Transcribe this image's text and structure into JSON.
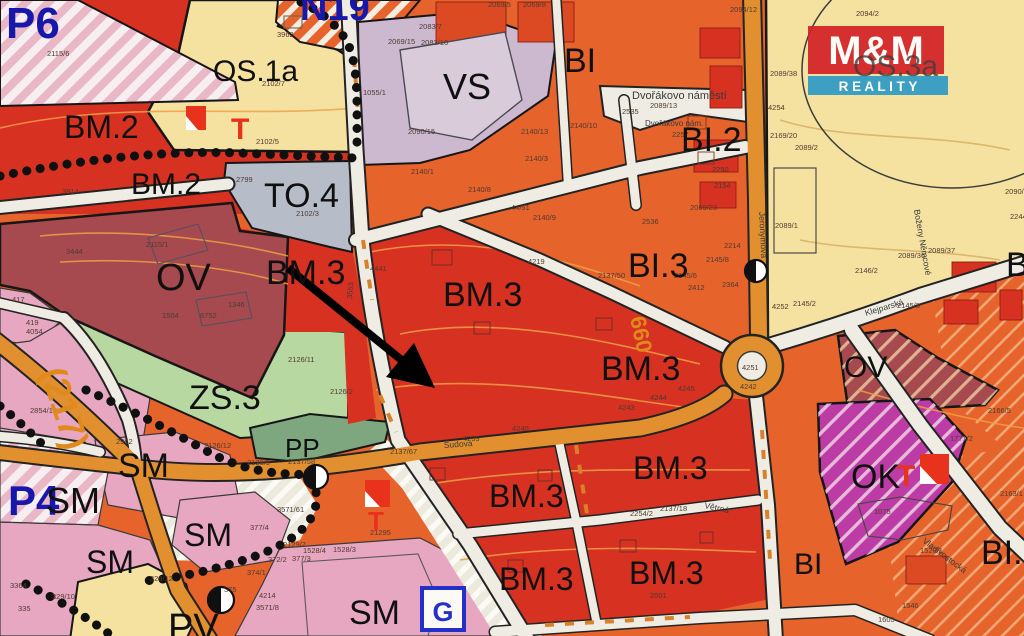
{
  "map": {
    "colors": {
      "bm_red": "#D73122",
      "bi_orange": "#E6632B",
      "os_yellow": "#F5E1A0",
      "vs_lavender": "#CDB9CF",
      "to_gray": "#B7BCC9",
      "ov_maroon": "#A64A4F",
      "zs_green": "#B8D8A2",
      "pp_green": "#7EA67F",
      "sm_pink": "#E7A7C1",
      "ok_magenta": "#BC3BA4",
      "road_cream": "#EFEDE3",
      "road_orange": "#E2902F",
      "plan_blue": "#1717AC",
      "logo_red": "#D42027",
      "logo_blue": "#2E9BC6"
    },
    "logo": {
      "top": "M&M",
      "bottom": "R E A L I T Y"
    },
    "icons": {
      "g": "G"
    },
    "region_labels": [
      {
        "t": "P6",
        "x": 6,
        "y": 38,
        "s": 44,
        "c": "#1717AC",
        "w": "bold"
      },
      {
        "t": "N19",
        "x": 300,
        "y": 20,
        "s": 38,
        "c": "#1717AC",
        "w": "bold"
      },
      {
        "t": "OS.1a",
        "x": 213,
        "y": 81,
        "s": 30
      },
      {
        "t": "BM.2",
        "x": 64,
        "y": 138,
        "s": 32
      },
      {
        "t": "BM.2",
        "x": 131,
        "y": 194,
        "s": 30
      },
      {
        "t": "TO.4",
        "x": 264,
        "y": 207,
        "s": 34
      },
      {
        "t": "VS",
        "x": 443,
        "y": 99,
        "s": 36
      },
      {
        "t": "BI",
        "x": 564,
        "y": 72,
        "s": 34
      },
      {
        "t": "BI.2",
        "x": 681,
        "y": 151,
        "s": 34
      },
      {
        "t": "OS.3a",
        "x": 853,
        "y": 76,
        "s": 30,
        "c": "#3E3E3E",
        "o": 0.8
      },
      {
        "t": "OV",
        "x": 156,
        "y": 290,
        "s": 38
      },
      {
        "t": "BM.3",
        "x": 266,
        "y": 284,
        "s": 34
      },
      {
        "t": "BM.3",
        "x": 443,
        "y": 306,
        "s": 34
      },
      {
        "t": "BI.3",
        "x": 628,
        "y": 277,
        "s": 34
      },
      {
        "t": "BM.3",
        "x": 601,
        "y": 380,
        "s": 34
      },
      {
        "t": "OV",
        "x": 844,
        "y": 377,
        "s": 30
      },
      {
        "t": "ZS.3",
        "x": 189,
        "y": 409,
        "s": 34
      },
      {
        "t": "PP",
        "x": 285,
        "y": 457,
        "s": 26
      },
      {
        "t": "SM",
        "x": 118,
        "y": 477,
        "s": 34
      },
      {
        "t": "P4",
        "x": 8,
        "y": 515,
        "s": 42,
        "c": "#1717AC",
        "w": "bold"
      },
      {
        "t": "SM",
        "x": 46,
        "y": 513,
        "s": 36
      },
      {
        "t": "SM",
        "x": 184,
        "y": 546,
        "s": 32
      },
      {
        "t": "SM",
        "x": 86,
        "y": 573,
        "s": 32
      },
      {
        "t": "BM.3",
        "x": 489,
        "y": 507,
        "s": 32
      },
      {
        "t": "BM.3",
        "x": 633,
        "y": 479,
        "s": 32
      },
      {
        "t": "OK",
        "x": 851,
        "y": 488,
        "s": 34
      },
      {
        "t": "BM.3",
        "x": 499,
        "y": 590,
        "s": 32
      },
      {
        "t": "BM.3",
        "x": 629,
        "y": 584,
        "s": 32
      },
      {
        "t": "SM",
        "x": 349,
        "y": 624,
        "s": 34
      },
      {
        "t": "PV",
        "x": 168,
        "y": 640,
        "s": 38
      },
      {
        "t": "BI",
        "x": 794,
        "y": 574,
        "s": 30
      },
      {
        "t": "BI.",
        "x": 981,
        "y": 564,
        "s": 34
      },
      {
        "t": "B",
        "x": 1006,
        "y": 276,
        "s": 34
      },
      {
        "t": "T",
        "x": 231,
        "y": 139,
        "s": 30,
        "c": "#E8321C",
        "w": "bold"
      },
      {
        "t": "T",
        "x": 368,
        "y": 530,
        "s": 26,
        "c": "#E8321C",
        "w": "bold"
      },
      {
        "t": "T",
        "x": 897,
        "y": 486,
        "s": 30,
        "c": "#E8321C",
        "w": "bold"
      }
    ],
    "route_labels": [
      {
        "t": "(217)",
        "x": 40,
        "y": 372,
        "s": 36,
        "r": 72
      },
      {
        "t": "660",
        "x": 630,
        "y": 318,
        "s": 22,
        "r": 78
      }
    ],
    "street_names": [
      {
        "t": "Dvořákovo náměstí",
        "x": 632,
        "y": 99,
        "s": 11
      },
      {
        "t": "Dvořákovo nám.",
        "x": 645,
        "y": 126,
        "s": 8
      },
      {
        "t": "Jeronýmova",
        "x": 759,
        "y": 212,
        "r": 87
      },
      {
        "t": "Boženy Němcové",
        "x": 914,
        "y": 210,
        "r": 80
      },
      {
        "t": "Klejparská",
        "x": 866,
        "y": 316,
        "r": -17
      },
      {
        "t": "Vladivostocká",
        "x": 922,
        "y": 542,
        "r": 37
      },
      {
        "t": "Větrná",
        "x": 704,
        "y": 508,
        "r": 12
      },
      {
        "t": "Šudova",
        "x": 444,
        "y": 448,
        "r": -4
      }
    ],
    "parcel_numbers": [
      {
        "t": "2115/6",
        "x": 47,
        "y": 56
      },
      {
        "t": "3962",
        "x": 277,
        "y": 37
      },
      {
        "t": "2102/7",
        "x": 262,
        "y": 86
      },
      {
        "t": "2102/5",
        "x": 256,
        "y": 144
      },
      {
        "t": "2102/3",
        "x": 296,
        "y": 216
      },
      {
        "t": "2799",
        "x": 236,
        "y": 182
      },
      {
        "t": "3914",
        "x": 62,
        "y": 194
      },
      {
        "t": "2115/1",
        "x": 146,
        "y": 247
      },
      {
        "t": "3444",
        "x": 66,
        "y": 254
      },
      {
        "t": "1504",
        "x": 162,
        "y": 318
      },
      {
        "t": "6752",
        "x": 200,
        "y": 318
      },
      {
        "t": "1346",
        "x": 228,
        "y": 307
      },
      {
        "t": "2126/11",
        "x": 288,
        "y": 362
      },
      {
        "t": "2126/2",
        "x": 330,
        "y": 394
      },
      {
        "t": "2126/12",
        "x": 204,
        "y": 448
      },
      {
        "t": "2126/9",
        "x": 247,
        "y": 465
      },
      {
        "t": "2137/58",
        "x": 288,
        "y": 464
      },
      {
        "t": "2962",
        "x": 116,
        "y": 444
      },
      {
        "t": "417",
        "x": 12,
        "y": 302
      },
      {
        "t": "419",
        "x": 26,
        "y": 325
      },
      {
        "t": "4054",
        "x": 26,
        "y": 334
      },
      {
        "t": "2854/15",
        "x": 30,
        "y": 413
      },
      {
        "t": "3571/61",
        "x": 277,
        "y": 512
      },
      {
        "t": "377/3",
        "x": 292,
        "y": 561
      },
      {
        "t": "377/4",
        "x": 250,
        "y": 530
      },
      {
        "t": "375",
        "x": 224,
        "y": 592
      },
      {
        "t": "374/1",
        "x": 247,
        "y": 575
      },
      {
        "t": "329/12",
        "x": 150,
        "y": 581
      },
      {
        "t": "329/10",
        "x": 52,
        "y": 599
      },
      {
        "t": "335",
        "x": 18,
        "y": 611
      },
      {
        "t": "3364",
        "x": 10,
        "y": 588
      },
      {
        "t": "1528/4",
        "x": 303,
        "y": 553
      },
      {
        "t": "1528/3",
        "x": 333,
        "y": 552
      },
      {
        "t": "2129/7",
        "x": 283,
        "y": 547
      },
      {
        "t": "4214",
        "x": 259,
        "y": 598
      },
      {
        "t": "3571/8",
        "x": 256,
        "y": 610
      },
      {
        "t": "372/2",
        "x": 268,
        "y": 562
      },
      {
        "t": "21295",
        "x": 370,
        "y": 535
      },
      {
        "t": "2137/67",
        "x": 390,
        "y": 454
      },
      {
        "t": "4240",
        "x": 512,
        "y": 431
      },
      {
        "t": "4239",
        "x": 463,
        "y": 441
      },
      {
        "t": "2137/18",
        "x": 660,
        "y": 511
      },
      {
        "t": "2254/2",
        "x": 630,
        "y": 516
      },
      {
        "t": "2001",
        "x": 650,
        "y": 598
      },
      {
        "t": "4441",
        "x": 370,
        "y": 271
      },
      {
        "t": "2137/50",
        "x": 598,
        "y": 278
      },
      {
        "t": "3553",
        "x": 352,
        "y": 299,
        "r": -85
      },
      {
        "t": "1055/1",
        "x": 363,
        "y": 95
      },
      {
        "t": "2069/15",
        "x": 388,
        "y": 44
      },
      {
        "t": "2083/7",
        "x": 419,
        "y": 29
      },
      {
        "t": "2083/10",
        "x": 421,
        "y": 45
      },
      {
        "t": "2090/15",
        "x": 408,
        "y": 134
      },
      {
        "t": "2140/13",
        "x": 521,
        "y": 134
      },
      {
        "t": "2140/1",
        "x": 411,
        "y": 174
      },
      {
        "t": "2140/3",
        "x": 525,
        "y": 161
      },
      {
        "t": "2140/8",
        "x": 468,
        "y": 192
      },
      {
        "t": "44/51",
        "x": 511,
        "y": 210
      },
      {
        "t": "2140/9",
        "x": 533,
        "y": 220
      },
      {
        "t": "4219",
        "x": 528,
        "y": 264
      },
      {
        "t": "2140/10",
        "x": 570,
        "y": 128
      },
      {
        "t": "2069/5",
        "x": 488,
        "y": 7
      },
      {
        "t": "2069/8",
        "x": 523,
        "y": 7
      },
      {
        "t": "2094/12",
        "x": 730,
        "y": 12
      },
      {
        "t": "2094/2",
        "x": 856,
        "y": 16
      },
      {
        "t": "2089/38",
        "x": 770,
        "y": 76
      },
      {
        "t": "4254",
        "x": 768,
        "y": 110
      },
      {
        "t": "2169/20",
        "x": 770,
        "y": 138
      },
      {
        "t": "2089/2",
        "x": 795,
        "y": 150
      },
      {
        "t": "2089/13",
        "x": 650,
        "y": 108
      },
      {
        "t": "2089/1",
        "x": 775,
        "y": 228
      },
      {
        "t": "2146/2",
        "x": 855,
        "y": 273
      },
      {
        "t": "2089/36",
        "x": 898,
        "y": 258
      },
      {
        "t": "2089/37",
        "x": 928,
        "y": 253
      },
      {
        "t": "2090/9",
        "x": 1005,
        "y": 194
      },
      {
        "t": "2244",
        "x": 1010,
        "y": 219
      },
      {
        "t": "2145/2",
        "x": 793,
        "y": 306
      },
      {
        "t": "4252",
        "x": 772,
        "y": 309
      },
      {
        "t": "2145/3",
        "x": 897,
        "y": 308
      },
      {
        "t": "4251",
        "x": 742,
        "y": 370
      },
      {
        "t": "4242",
        "x": 740,
        "y": 389
      },
      {
        "t": "4245",
        "x": 678,
        "y": 391
      },
      {
        "t": "4244",
        "x": 650,
        "y": 400
      },
      {
        "t": "4243",
        "x": 618,
        "y": 410
      },
      {
        "t": "2536",
        "x": 642,
        "y": 224
      },
      {
        "t": "2069/23",
        "x": 690,
        "y": 210
      },
      {
        "t": "2145/6",
        "x": 674,
        "y": 278
      },
      {
        "t": "2364",
        "x": 722,
        "y": 287
      },
      {
        "t": "2412",
        "x": 688,
        "y": 290
      },
      {
        "t": "2214",
        "x": 724,
        "y": 248
      },
      {
        "t": "2535",
        "x": 622,
        "y": 114
      },
      {
        "t": "2257",
        "x": 672,
        "y": 137
      },
      {
        "t": "2250",
        "x": 712,
        "y": 172
      },
      {
        "t": "2154",
        "x": 714,
        "y": 188
      },
      {
        "t": "2166/5",
        "x": 988,
        "y": 413
      },
      {
        "t": "1771/2",
        "x": 950,
        "y": 441
      },
      {
        "t": "2163/1",
        "x": 1000,
        "y": 496
      },
      {
        "t": "1075",
        "x": 874,
        "y": 514
      },
      {
        "t": "1520/1",
        "x": 920,
        "y": 553
      },
      {
        "t": "2145/8",
        "x": 706,
        "y": 262
      },
      {
        "t": "1546",
        "x": 902,
        "y": 608
      },
      {
        "t": "1605",
        "x": 878,
        "y": 622
      }
    ]
  }
}
